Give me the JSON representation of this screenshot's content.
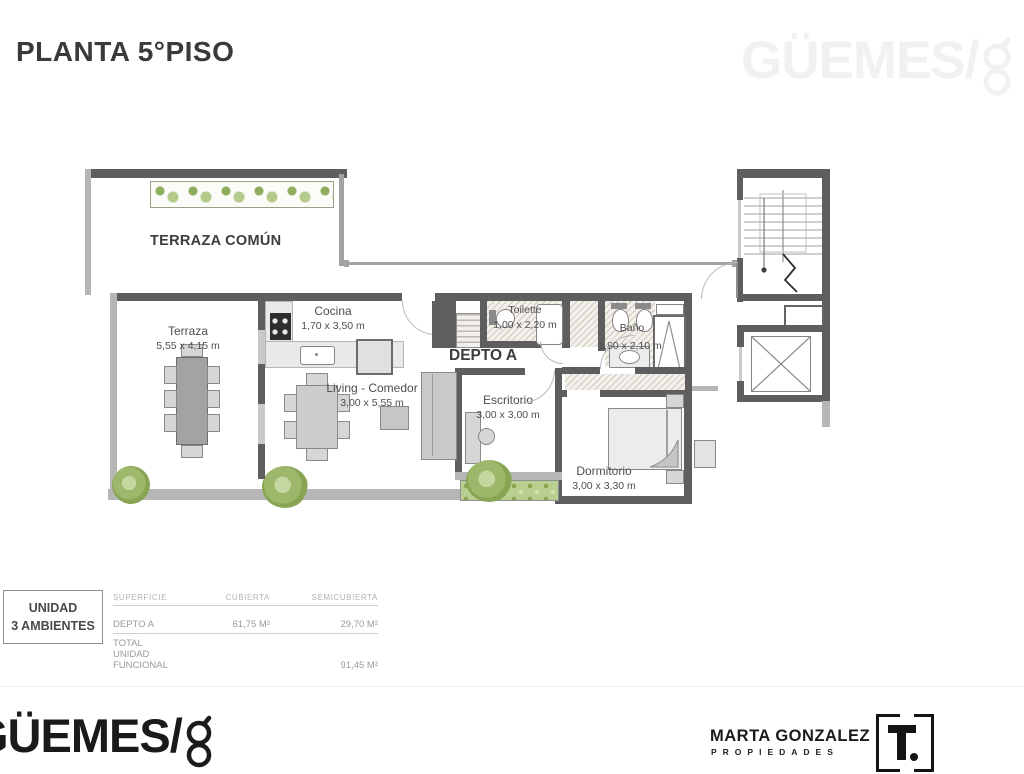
{
  "title": "PLANTA 5°PISO",
  "brand": {
    "wordmark": "GÜEMES/",
    "mark": "8"
  },
  "plan": {
    "common_terrace_label": "TERRAZA COMÚN",
    "unit_label": "DEPTO A",
    "rooms": [
      {
        "label": "Terraza",
        "dims": "5,55 x 4,15 m"
      },
      {
        "label": "Cocina",
        "dims": "1,70 x 3,50 m"
      },
      {
        "label": "Living - Comedor",
        "dims": "3,00 x 5,55 m"
      },
      {
        "label": "Toilette",
        "dims": "1,00 x 2,20 m"
      },
      {
        "label": "Baño",
        "dims": "1,80 x 2,10 m"
      },
      {
        "label": "Escritorio",
        "dims": "3,00 x 3,00 m"
      },
      {
        "label": "Dormitorio",
        "dims": "3,00 x 3,30 m"
      }
    ]
  },
  "summary": {
    "unit": {
      "line1": "UNIDAD",
      "line2": "3 AMBIENTES"
    },
    "table": {
      "headers": [
        "SUPERFICIE",
        "CUBIERTA",
        "SEMICUBIERTA"
      ],
      "rows": [
        {
          "name": "DEPTO A",
          "cubierta": "61,75 M²",
          "semicubierta": "29,70 M²"
        }
      ],
      "total": {
        "label": "TOTAL UNIDAD FUNCIONAL",
        "value": "91,45 M²"
      }
    }
  },
  "footer": {
    "agency": {
      "name": "MARTA GONZALEZ",
      "tagline": "PROPIEDADES"
    },
    "builder_logo": "T."
  },
  "colors": {
    "wall_dark": "#5e5e5e",
    "wall_light": "#b6b6b6",
    "plant_green": "#9cb96a",
    "title_text": "#3a3a3a",
    "watermark": "#f1f1f1"
  }
}
